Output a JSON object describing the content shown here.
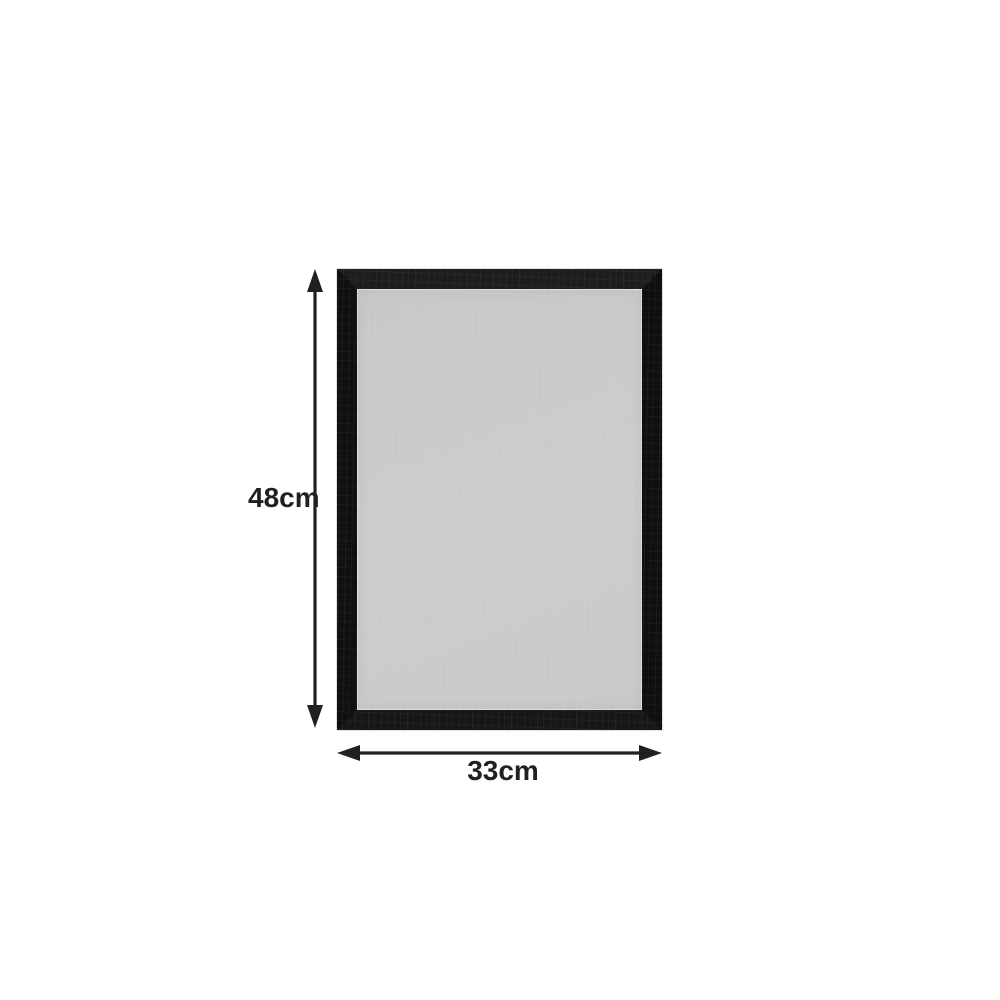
{
  "product": {
    "name": "black-rectangular-frame",
    "frame_color": "#141414",
    "board_color": "#cbcbcb",
    "inner_edge_color": "#dedede",
    "background_color": "#ffffff"
  },
  "annotations": {
    "arrow_color": "#231f20",
    "height": {
      "label": "48cm"
    },
    "width": {
      "label": "33cm"
    }
  }
}
